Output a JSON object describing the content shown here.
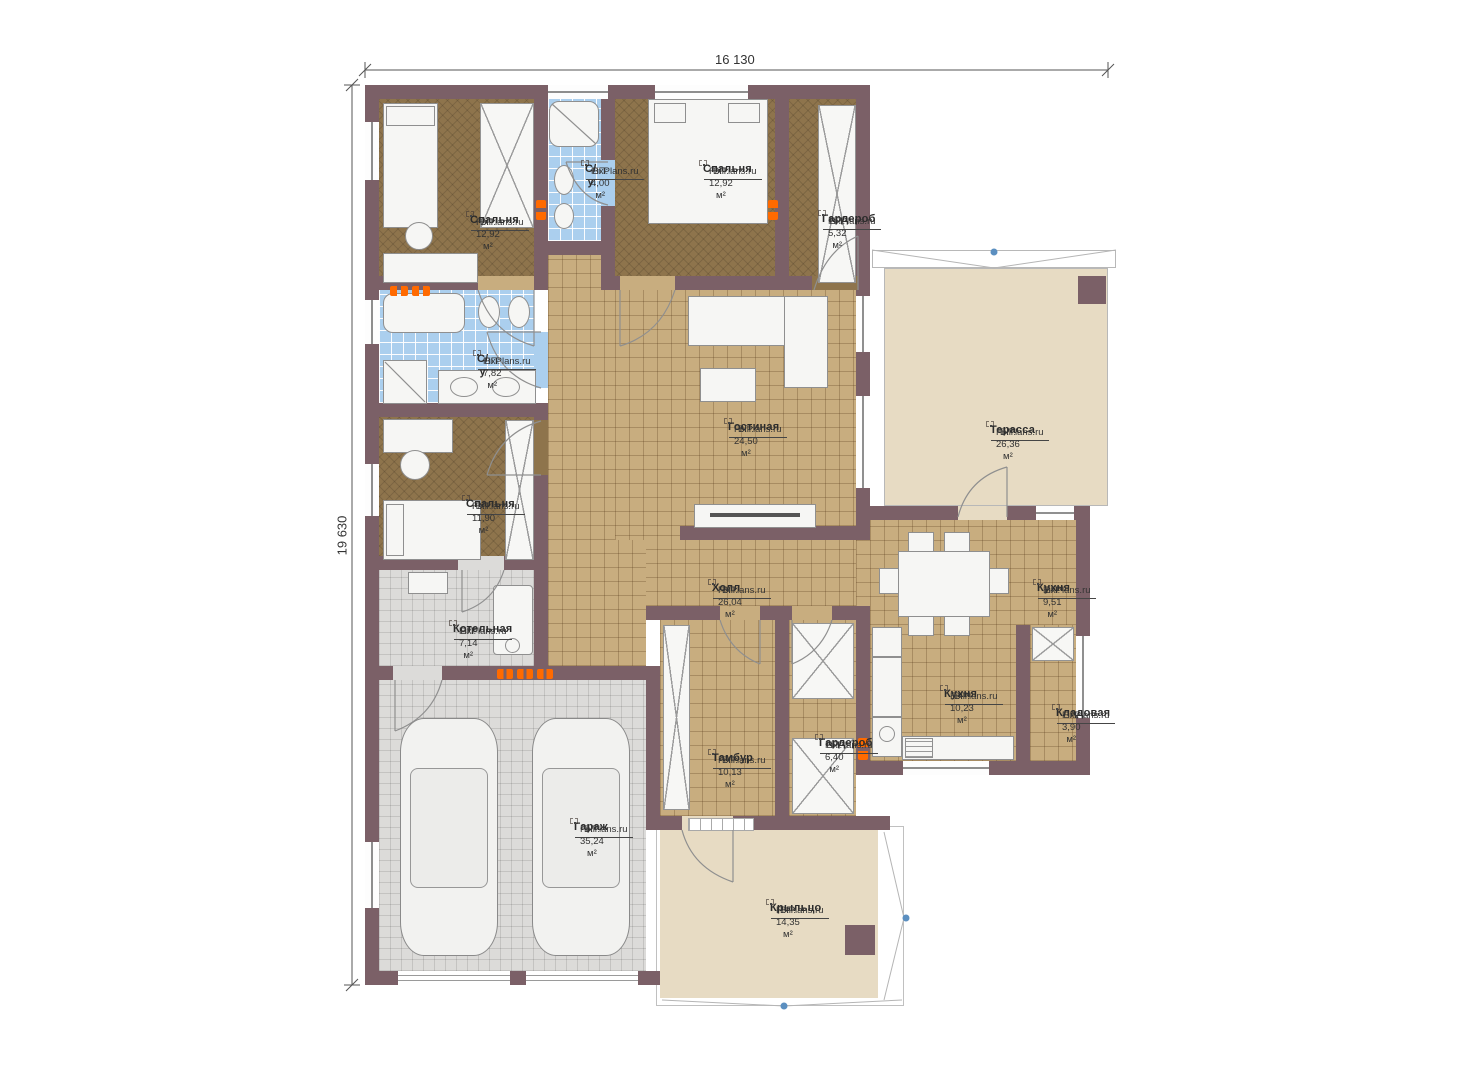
{
  "plan": {
    "dimensions": {
      "width_label": "16 130",
      "height_label": "19 630"
    },
    "watermark": "FixPlans.ru",
    "rooms": [
      {
        "name": "Спальня",
        "watermark": "FixPlans.ru",
        "area": "ВП: 12,92 м²"
      },
      {
        "name": "С/у",
        "watermark": "FixPlans.ru",
        "area": "ВП: 4,00 м²"
      },
      {
        "name": "Спальня",
        "watermark": "FixPlans.ru",
        "area": "ВП: 12,92 м²"
      },
      {
        "name": "Гардероб",
        "watermark": "FixPlans.ru",
        "area": "ВП: 5,32 м²"
      },
      {
        "name": "С/у",
        "watermark": "FixPlans.ru",
        "area": "ВП: 7,82 м²"
      },
      {
        "name": "Гостиная",
        "watermark": "FixPlans.ru",
        "area": "ВП: 24,50 м²"
      },
      {
        "name": "Терасса",
        "watermark": "FixPlans.ru",
        "area": "ВП: 26,36 м²"
      },
      {
        "name": "Спальня",
        "watermark": "FixPlans.ru",
        "area": "ВП: 11,90 м²"
      },
      {
        "name": "Холл",
        "watermark": "FixPlans.ru",
        "area": "ВП: 26,04 м²"
      },
      {
        "name": "Кухня",
        "watermark": "FixPlans.ru",
        "area": "ВП: 9,51 м²"
      },
      {
        "name": "Котельная",
        "watermark": "FixPlans.ru",
        "area": "ВП: 7,14 м²"
      },
      {
        "name": "Кухня",
        "watermark": "FixPlans.ru",
        "area": "ВП: 10,23 м²"
      },
      {
        "name": "Кладовая",
        "watermark": "FixPlans.ru",
        "area": "ВП: 3,90 м²"
      },
      {
        "name": "Тамбур",
        "watermark": "FixPlans.ru",
        "area": "ВП: 10,13 м²"
      },
      {
        "name": "Гардероб",
        "watermark": "FixPlans.ru",
        "area": "ВП: 6,40 м²"
      },
      {
        "name": "Гараж",
        "watermark": "FixPlans.ru",
        "area": "ВП: 35,24 м²"
      },
      {
        "name": "Крыльцо",
        "watermark": "FixPlans.ru",
        "area": "ВП: 14,35 м²"
      }
    ],
    "colors": {
      "wall": "#7b6067",
      "floor_wood": "#8e744c",
      "floor_tile_tan": "#c8ad7f",
      "floor_tile_blue": "#abcfee",
      "floor_tile_gray": "#dcdbd9",
      "floor_terrace": "#e7dbc3",
      "radiator": "#ff6a00"
    }
  }
}
